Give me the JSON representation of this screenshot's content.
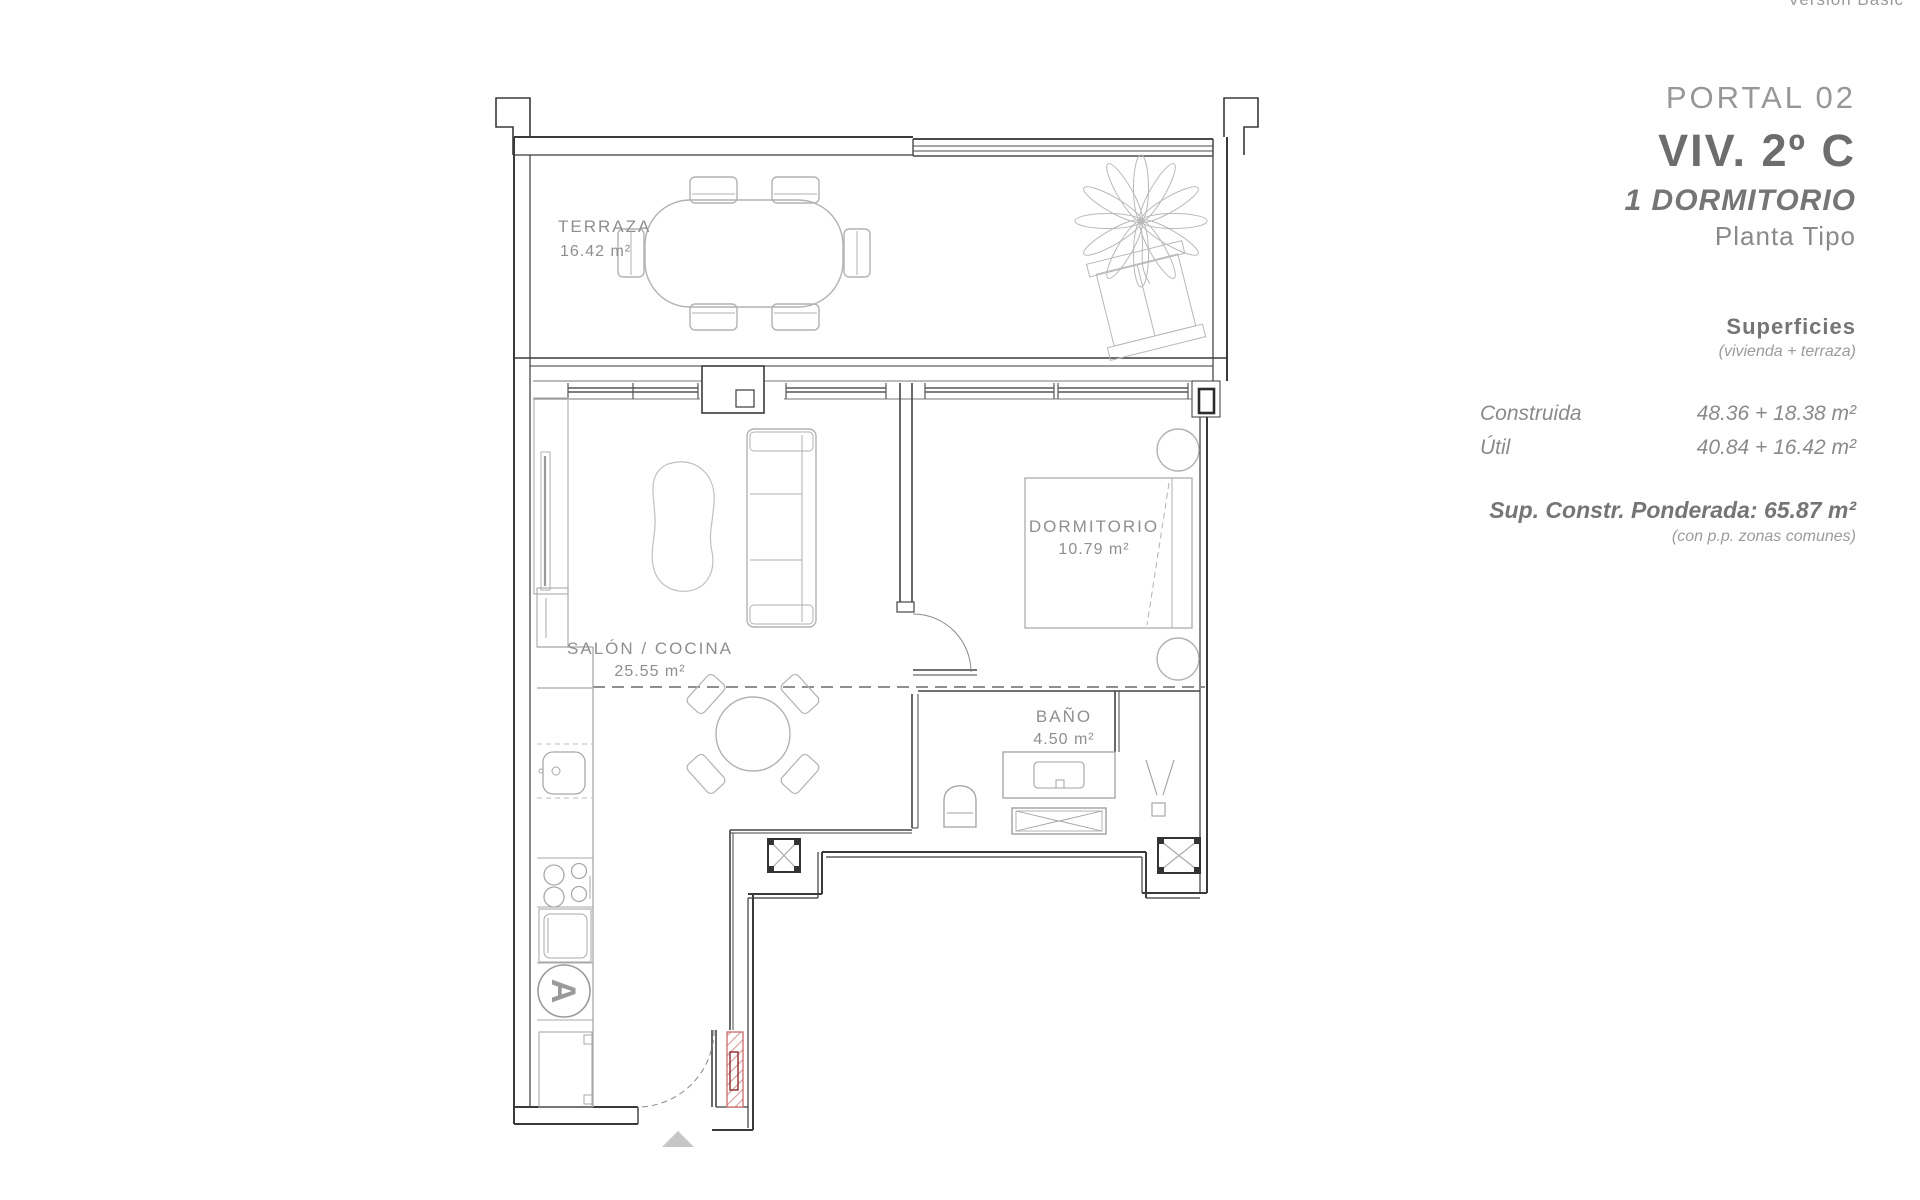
{
  "window_note": "*Versión Basic",
  "panel": {
    "portal": "PORTAL 02",
    "unit": "VIV. 2º C",
    "apt_type": "1 DORMITORIO",
    "floor_type": "Planta Tipo",
    "surfaces_title": "Superficies",
    "surfaces_subtitle": "(vivienda + terraza)",
    "rows": [
      {
        "label": "Construida",
        "value": "48.36 + 18.38 m²"
      },
      {
        "label": "Útil",
        "value": "40.84 + 16.42 m²"
      }
    ],
    "weighted": "Sup. Constr. Ponderada: 65.87 m²",
    "weighted_note": "(con p.p. zonas comunes)"
  },
  "plan": {
    "rooms": [
      {
        "name": "TERRAZA",
        "area": "16.42 m²"
      },
      {
        "name": "SALÓN / COCINA",
        "area": "25.55 m²"
      },
      {
        "name": "DORMITORIO",
        "area": "10.79 m²"
      },
      {
        "name": "BAÑO",
        "area": "4.50 m²"
      }
    ],
    "appliance_label": "A"
  },
  "colors": {
    "wall": "#3a3a3a",
    "window_line": "#777777",
    "furniture": "#b2b2b2",
    "label_gray": "#8f8f8f",
    "accent_red": "#c96a6a",
    "accent_red_dark": "#8c2b2b",
    "arrow_gray": "#c6c6c6"
  }
}
